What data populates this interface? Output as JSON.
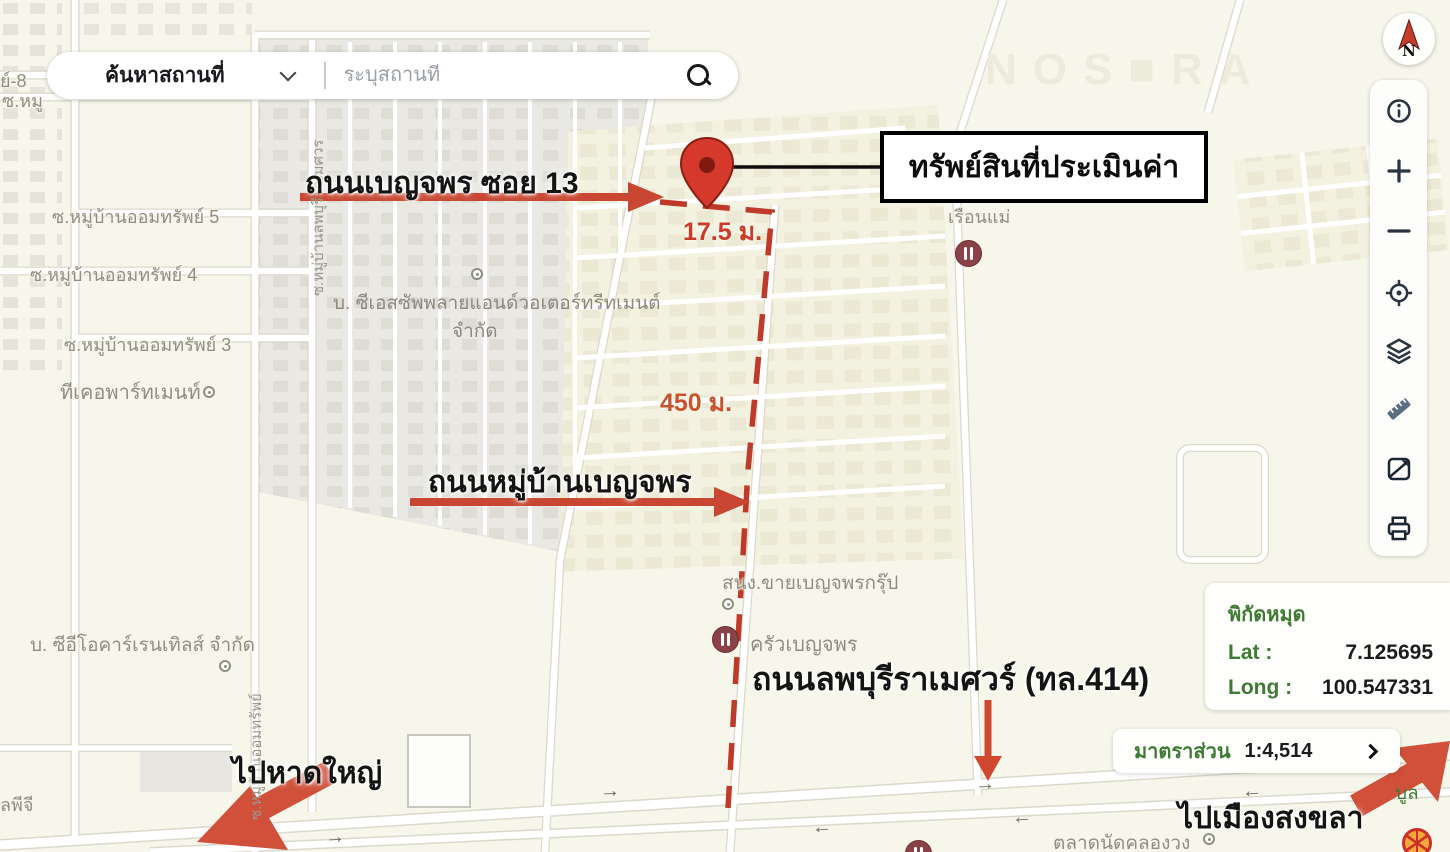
{
  "search": {
    "category_label": "ค้นหาสถานที่",
    "placeholder": "ระบุสถานที่"
  },
  "compass": {
    "north_letter": "N"
  },
  "coords_panel": {
    "title": "พิกัดหมุด",
    "lat_label": "Lat :",
    "lat_value": "7.125695",
    "long_label": "Long :",
    "long_value": "100.547331"
  },
  "scale_bar": {
    "label": "มาตราส่วน",
    "value": "1:4,514"
  },
  "annotations": {
    "property_callout": "ทรัพย์สินที่ประเมินค่า",
    "road_soi_13": "ถนนเบญจพร ซอย 13",
    "distance_17_5": "17.5 ม.",
    "distance_450": "450 ม.",
    "road_village": "ถนนหมู่บ้านเบญจพร",
    "road_highway": "ถนนลพบุรีราเมศวร์ (ทล.414)",
    "to_hatyai": "ไปหาดใหญ่",
    "to_songkhla": "ไปเมืองสงขลา"
  },
  "map_labels": {
    "soi_omsap_5": "ซ.หมู่บ้านออมทรัพย์ 5",
    "soi_omsap_4": "ซ.หมู่บ้านออมทรัพย์ 4",
    "soi_omsap_3": "ซ.หมู่บ้านออมทรัพย์ 3",
    "tk_apartment": "ทีเคอพาร์ทเมนท์",
    "cs_supply_line1": "บ. ซีเอสซัพพลายแอนด์วอเตอร์ทรีทเมนต์",
    "cs_supply_line2": "จำกัด",
    "benjaporn_office": "สนง.ขายเบญจพรกรุ๊ป",
    "krua_benjaporn": "ครัวเบญจพร",
    "ruen_mae": "เรือนแม่",
    "ceo_car_rentals": "บ. ซีอีโอคาร์เรนเทิลส์ จำกัด",
    "market": "ตลาดนัดคลองวง",
    "soi_lopburi_vertical": "ซ.หมู่บ้านลพบุรีราเมศวร",
    "soi_omsap_vertical": "ซ.หมู่บ้านออมทรัพย์",
    "partial_soi_8": "ย์-8",
    "partial_soi_top": "ซ.หมู",
    "partial_lpg": "ลพีจี",
    "partial_green": "บูล",
    "watermark": "NOS■RA"
  },
  "colors": {
    "annotation_red": "#c94732",
    "pin_red": "#d5392b",
    "panel_green": "#3e7a33",
    "map_label_gray": "#8f8e84",
    "background": "#f7f6ea"
  }
}
